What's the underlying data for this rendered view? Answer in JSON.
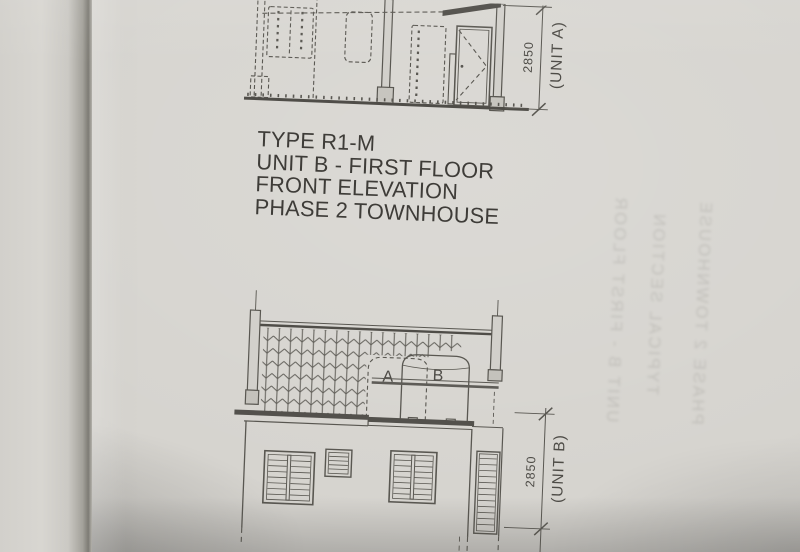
{
  "title_block": {
    "lines": [
      "TYPE R1-M",
      "UNIT B - FIRST FLOOR",
      "FRONT ELEVATION",
      "PHASE 2 TOWNHOUSE"
    ]
  },
  "top_elevation": {
    "dimension_text": "2850",
    "unit_label": "(UNIT A)"
  },
  "bottom_elevation": {
    "dimension_text": "2850",
    "unit_label": "(UNIT B)",
    "tank_label_a": "A",
    "tank_label_b": "B",
    "partial_dimension_label": "("
  },
  "showthrough": {
    "lines": [
      "UNIT B - FIRST FLOOR",
      "TYPICAL SECTION",
      "PHASE 2 TOWNHOUSE"
    ]
  },
  "colors": {
    "paper": "#d6d4cf",
    "line": "#4c4a45",
    "ink_text": "#3e3c38"
  }
}
